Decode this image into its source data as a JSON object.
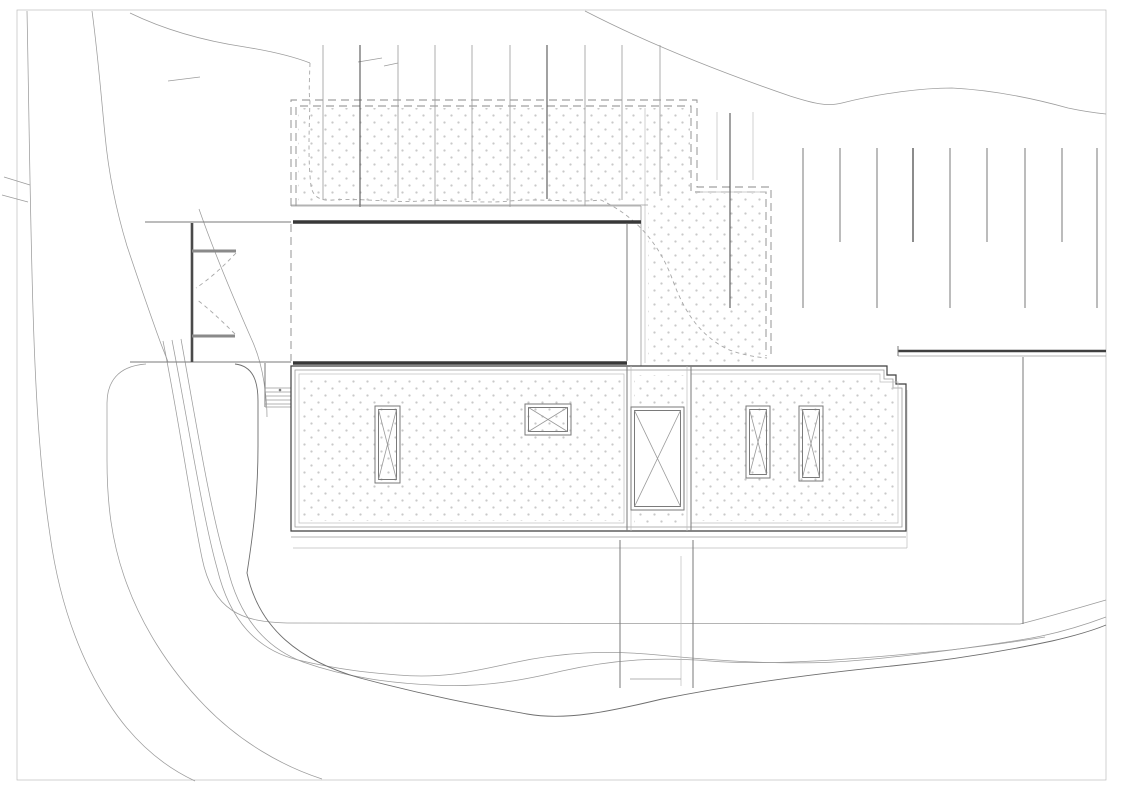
{
  "document": {
    "kind": "architectural-site-roof-plan",
    "visible_text": [],
    "background": "#ffffff"
  },
  "palette": {
    "paper": "#ffffff",
    "dot_color": "#c9c9c9",
    "wall_dark": "#383838",
    "classes": {
      "hair": {
        "stroke": "#bdbdbd",
        "w": 0.7
      },
      "thin": {
        "stroke": "#9a9a9a",
        "w": 0.8
      },
      "med": {
        "stroke": "#7a7a7a",
        "w": 1.0
      },
      "dark": {
        "stroke": "#555555",
        "w": 1.1
      },
      "xdark": {
        "stroke": "#3f3f3f",
        "w": 1.2
      },
      "wall": {
        "stroke": "#383838",
        "w": 3.4
      },
      "wallmed": {
        "stroke": "#4a4a4a",
        "w": 2.6
      },
      "graybar": {
        "stroke": "#8a8a8a",
        "w": 3.0
      },
      "railwall": {
        "stroke": "#3f3f3f",
        "w": 2.4
      },
      "contour": {
        "stroke": "#9c9c9c",
        "w": 0.75
      },
      "contour2": {
        "stroke": "#6e6e6e",
        "w": 0.9
      },
      "dash": {
        "stroke": "#8a8a8a",
        "w": 0.9,
        "dash": "8 5"
      },
      "dashfine": {
        "stroke": "#a8a8a8",
        "w": 0.9,
        "dash": "4 3.5"
      }
    },
    "dot_pattern": {
      "tile": 14,
      "radius": 1.15,
      "points": [
        [
          3.5,
          3.5
        ],
        [
          10.5,
          10.5
        ]
      ]
    }
  },
  "canvas": {
    "width": 1123,
    "height": 794
  },
  "counts": {
    "skylights": 5,
    "pergola_lines": 10,
    "planting_lines": 9,
    "stair_treads": 4
  },
  "layers": [
    {
      "name": "sheet-border",
      "items": [
        {
          "kind": "rect",
          "x": 17,
          "y": 10,
          "w": 1089,
          "h": 770,
          "cls": "hair",
          "fill": "none"
        }
      ]
    },
    {
      "name": "terrain-contours",
      "items": [
        {
          "kind": "path",
          "cls": "contour",
          "d": "M27,11 C29,110 30,210 33,310 C36,410 41,475 50,535 C59,600 78,655 108,702 C134,743 165,767 195,781"
        },
        {
          "kind": "path",
          "cls": "contour",
          "d": "M92,11 C98,55 101,95 105,135 C109,178 117,213 127,246 C137,276 147,305 157,333 C163,350 166,356 168,362"
        },
        {
          "kind": "path",
          "cls": "contour",
          "d": "M130,13 C165,30 205,41 245,47 C270,51 292,56 310,63"
        },
        {
          "kind": "path",
          "cls": "contour",
          "d": "M585,11 C645,42 720,72 790,96 C812,103 827,107 842,103 C882,93 922,88 952,88 C992,90 1032,98 1068,108 C1082,111 1096,113 1106,114"
        },
        {
          "kind": "path",
          "cls": "contour",
          "d": "M199,209 C214,252 233,297 251,338 C258,353 263,372 265,390 C267,404 267,410 267,417"
        },
        {
          "kind": "path",
          "cls": "contour",
          "d": "M146,364 C117,366 107,383 107,403 L107,460 C107,505 112,541 124,576 C140,623 168,668 205,706 C240,742 282,766 322,779"
        },
        {
          "kind": "path",
          "cls": "contour",
          "d": "M163,341 C179,420 190,500 202,558 C213,612 243,622 287,623 L1020,624 C1048,617 1078,608 1106,600"
        },
        {
          "kind": "path",
          "cls": "contour",
          "d": "M172,340 C189,428 203,518 217,568 C230,622 258,650 298,660 C340,670 372,673 398,675 C443,679 475,671 512,663 C562,652 608,650 658,655 C730,662 800,666 862,660 C920,655 975,647 1020,640 C1052,635 1082,626 1106,617"
        },
        {
          "kind": "path",
          "cls": "contour",
          "d": "M181,339 C197,428 211,515 227,566 C239,618 266,648 303,662 C348,678 392,683 433,685 C483,688 524,680 562,671 C615,659 660,657 710,661 C770,666 860,659 950,650 C985,646 1015,642 1045,637"
        },
        {
          "kind": "path",
          "cls": "contour2",
          "d": "M235,364 C253,366 258,381 258,401 L258,446 C258,500 252,541 247,573 C259,629 300,661 360,678 C432,697 483,706 527,714 C567,721 612,711 662,699 C732,685 812,674 892,666 C952,660 1010,650 1052,641 C1078,635 1094,630 1106,625"
        },
        {
          "kind": "path",
          "cls": "contour",
          "d": "M4,177 L30,185"
        },
        {
          "kind": "path",
          "cls": "contour",
          "d": "M2,195 L28,202"
        },
        {
          "kind": "path",
          "cls": "contour",
          "d": "M358,62 L382,58"
        },
        {
          "kind": "path",
          "cls": "contour",
          "d": "M384,66 L398,63"
        },
        {
          "kind": "path",
          "cls": "contour",
          "d": "M168,81 L200,77"
        }
      ]
    },
    {
      "name": "gravel-terrace",
      "items": [
        {
          "kind": "poly",
          "fill": "dots",
          "pts": "298,108 690,108 690,193 764,193 764,364 648,364 648,205 298,205"
        },
        {
          "kind": "poly",
          "cls": "dash",
          "fill": "none",
          "pts": "291,206 291,100 697,100 697,187 771,187 771,356"
        },
        {
          "kind": "poly",
          "cls": "dash",
          "fill": "none",
          "pts": "296,206 296,106 691,106 691,192 766,192 766,356"
        },
        {
          "kind": "line",
          "x1": 700,
          "y1": 192,
          "x2": 766,
          "y2": 192,
          "cls": "hair"
        },
        {
          "kind": "line",
          "x1": 645,
          "y1": 108,
          "x2": 645,
          "y2": 363,
          "cls": "hair"
        },
        {
          "kind": "line",
          "x1": 291,
          "y1": 205,
          "x2": 648,
          "y2": 205,
          "cls": "thin"
        },
        {
          "kind": "path",
          "cls": "dashfine",
          "d": "M310,63 C309,90 309,95 310,100 C309,132 308,162 311,186 C313,197 320,201 333,200 C363,198 392,203 421,201 C451,199 480,204 510,201 C540,198 572,203 601,200 C641,219 662,250 673,281 C686,316 702,336 727,349 C742,355 756,357 767,358"
        }
      ]
    },
    {
      "name": "pergola-lines",
      "items": [
        {
          "kind": "vlines",
          "cls": "thin",
          "y1": 45,
          "xs": [
            323,
            360,
            398,
            435,
            472,
            510,
            547,
            585,
            622,
            660
          ],
          "y2s": [
            200,
            207,
            198,
            205,
            200,
            207,
            199,
            206,
            200,
            196
          ],
          "darkIdx": [
            1,
            6
          ]
        },
        {
          "kind": "line",
          "x1": 730,
          "y1": 113,
          "x2": 730,
          "y2": 308,
          "cls": "dark"
        },
        {
          "kind": "line",
          "x1": 717,
          "y1": 112,
          "x2": 717,
          "y2": 180,
          "cls": "hair"
        },
        {
          "kind": "line",
          "x1": 753,
          "y1": 112,
          "x2": 753,
          "y2": 180,
          "cls": "hair"
        }
      ]
    },
    {
      "name": "planting-lines-east",
      "items": [
        {
          "kind": "vlines",
          "cls": "med",
          "y1": 148,
          "xs": [
            803,
            840,
            877,
            913,
            950,
            987,
            1025,
            1062,
            1097
          ],
          "y2s": [
            308,
            242,
            308,
            242,
            308,
            242,
            308,
            242,
            308
          ],
          "darkIdx": [
            3
          ]
        }
      ]
    },
    {
      "name": "upper-building-block",
      "items": [
        {
          "kind": "line",
          "x1": 291,
          "y1": 206,
          "x2": 641,
          "y2": 206,
          "cls": "thin"
        },
        {
          "kind": "line",
          "x1": 641,
          "y1": 206,
          "x2": 641,
          "y2": 368,
          "cls": "thin"
        },
        {
          "kind": "line",
          "x1": 293,
          "y1": 222,
          "x2": 641,
          "y2": 222,
          "cls": "wall"
        },
        {
          "kind": "line",
          "x1": 293,
          "y1": 363,
          "x2": 627,
          "y2": 363,
          "cls": "wall"
        },
        {
          "kind": "line",
          "x1": 627,
          "y1": 224,
          "x2": 627,
          "y2": 361,
          "cls": "med"
        },
        {
          "kind": "line",
          "x1": 291,
          "y1": 224,
          "x2": 291,
          "y2": 361,
          "cls": "dash"
        }
      ]
    },
    {
      "name": "entry-gate",
      "items": [
        {
          "kind": "line",
          "x1": 145,
          "y1": 222,
          "x2": 291,
          "y2": 222,
          "cls": "med"
        },
        {
          "kind": "line",
          "x1": 130,
          "y1": 362,
          "x2": 291,
          "y2": 362,
          "cls": "med"
        },
        {
          "kind": "line",
          "x1": 192,
          "y1": 223,
          "x2": 192,
          "y2": 362,
          "cls": "wallmed"
        },
        {
          "kind": "line",
          "x1": 192,
          "y1": 251,
          "x2": 236,
          "y2": 251,
          "cls": "graybar"
        },
        {
          "kind": "line",
          "x1": 192,
          "y1": 336,
          "x2": 235,
          "y2": 336,
          "cls": "graybar"
        },
        {
          "kind": "path",
          "cls": "dashfine",
          "d": "M236,253 C222,268 208,280 196,288"
        },
        {
          "kind": "path",
          "cls": "dashfine",
          "d": "M235,334 C221,320 208,308 196,299"
        }
      ]
    },
    {
      "name": "west-stair",
      "items": [
        {
          "kind": "line",
          "x1": 265,
          "y1": 363,
          "x2": 265,
          "y2": 407,
          "cls": "med"
        },
        {
          "kind": "line",
          "x1": 291,
          "y1": 388,
          "x2": 291,
          "y2": 407,
          "cls": "med"
        },
        {
          "kind": "line",
          "x1": 265,
          "y1": 388,
          "x2": 291,
          "y2": 388,
          "cls": "thin"
        },
        {
          "kind": "line",
          "x1": 265,
          "y1": 392,
          "x2": 291,
          "y2": 392,
          "cls": "thin"
        },
        {
          "kind": "line",
          "x1": 265,
          "y1": 396,
          "x2": 291,
          "y2": 396,
          "cls": "thin"
        },
        {
          "kind": "line",
          "x1": 265,
          "y1": 400,
          "x2": 291,
          "y2": 400,
          "cls": "thin"
        },
        {
          "kind": "line",
          "x1": 265,
          "y1": 404,
          "x2": 291,
          "y2": 404,
          "cls": "thin"
        },
        {
          "kind": "line",
          "x1": 265,
          "y1": 407,
          "x2": 291,
          "y2": 407,
          "cls": "thin"
        },
        {
          "kind": "circle",
          "cx": 280,
          "cy": 390,
          "r": 1.3,
          "fillc": "#7a7a7a"
        }
      ]
    },
    {
      "name": "main-roof",
      "items": [
        {
          "kind": "path",
          "cls": "xdark",
          "fill": "#ffffff",
          "d": "M291,366 L887,366 L887,375 L896,375 L896,384 L906,384 L906,531 L291,531 Z"
        },
        {
          "kind": "path",
          "cls": "thin",
          "fill": "none",
          "d": "M295,370 L884,370 L884,379 L893,379 L893,388 L902,388 L902,527 L295,527 Z"
        },
        {
          "kind": "rect",
          "x": 299,
          "y": 374,
          "w": 325,
          "h": 149,
          "cls": "hair",
          "fill": "none"
        },
        {
          "kind": "path",
          "cls": "hair",
          "fill": "none",
          "d": "M691,374 L880,374 L880,382 L898,382 L898,523 L691,523 Z"
        },
        {
          "kind": "line",
          "x1": 291,
          "y1": 537,
          "x2": 906,
          "y2": 537,
          "cls": "thin"
        },
        {
          "kind": "line",
          "x1": 293,
          "y1": 548,
          "x2": 907,
          "y2": 548,
          "cls": "hair"
        },
        {
          "kind": "line",
          "x1": 907,
          "y1": 390,
          "x2": 907,
          "y2": 548,
          "cls": "hair"
        },
        {
          "kind": "line",
          "x1": 627,
          "y1": 366,
          "x2": 627,
          "y2": 531,
          "cls": "med"
        },
        {
          "kind": "line",
          "x1": 631,
          "y1": 366,
          "x2": 631,
          "y2": 531,
          "cls": "hair"
        },
        {
          "kind": "line",
          "x1": 687,
          "y1": 366,
          "x2": 687,
          "y2": 531,
          "cls": "hair"
        },
        {
          "kind": "line",
          "x1": 691,
          "y1": 366,
          "x2": 691,
          "y2": 531,
          "cls": "med"
        },
        {
          "kind": "rect",
          "x": 302,
          "y": 377,
          "w": 319,
          "h": 144,
          "fill": "dots"
        },
        {
          "kind": "path",
          "fill": "dots",
          "d": "M694,377 L881,377 L881,384 L897,384 L897,521 L694,521 Z"
        },
        {
          "kind": "rect",
          "x": 634,
          "y": 375,
          "w": 50,
          "h": 30,
          "fill": "dots"
        },
        {
          "kind": "rect",
          "x": 634,
          "y": 512,
          "w": 50,
          "h": 13,
          "fill": "dots"
        },
        {
          "kind": "skylight",
          "x": 375,
          "y": 406,
          "w": 25,
          "h": 77
        },
        {
          "kind": "skylight",
          "x": 525,
          "y": 404,
          "w": 46,
          "h": 31
        },
        {
          "kind": "skylight",
          "x": 631,
          "y": 407,
          "w": 53,
          "h": 103
        },
        {
          "kind": "skylight",
          "x": 746,
          "y": 406,
          "w": 24,
          "h": 72
        },
        {
          "kind": "skylight",
          "x": 799,
          "y": 406,
          "w": 24,
          "h": 75
        }
      ]
    },
    {
      "name": "hillside-stair-path",
      "items": [
        {
          "kind": "line",
          "x1": 620,
          "y1": 540,
          "x2": 620,
          "y2": 688,
          "cls": "med"
        },
        {
          "kind": "line",
          "x1": 693,
          "y1": 540,
          "x2": 693,
          "y2": 688,
          "cls": "med"
        },
        {
          "kind": "line",
          "x1": 681,
          "y1": 556,
          "x2": 681,
          "y2": 686,
          "cls": "hair"
        },
        {
          "kind": "line",
          "x1": 630,
          "y1": 679,
          "x2": 681,
          "y2": 679,
          "cls": "thin"
        }
      ]
    },
    {
      "name": "retaining-wall-east",
      "items": [
        {
          "kind": "line",
          "x1": 898,
          "y1": 351,
          "x2": 1106,
          "y2": 351,
          "cls": "railwall"
        },
        {
          "kind": "line",
          "x1": 898,
          "y1": 356,
          "x2": 1106,
          "y2": 356,
          "cls": "thin"
        },
        {
          "kind": "line",
          "x1": 898,
          "y1": 346,
          "x2": 898,
          "y2": 356,
          "cls": "med"
        }
      ]
    },
    {
      "name": "neighbor-plot-line",
      "items": [
        {
          "kind": "line",
          "x1": 1023,
          "y1": 357,
          "x2": 1023,
          "y2": 624,
          "cls": "med"
        }
      ]
    }
  ]
}
